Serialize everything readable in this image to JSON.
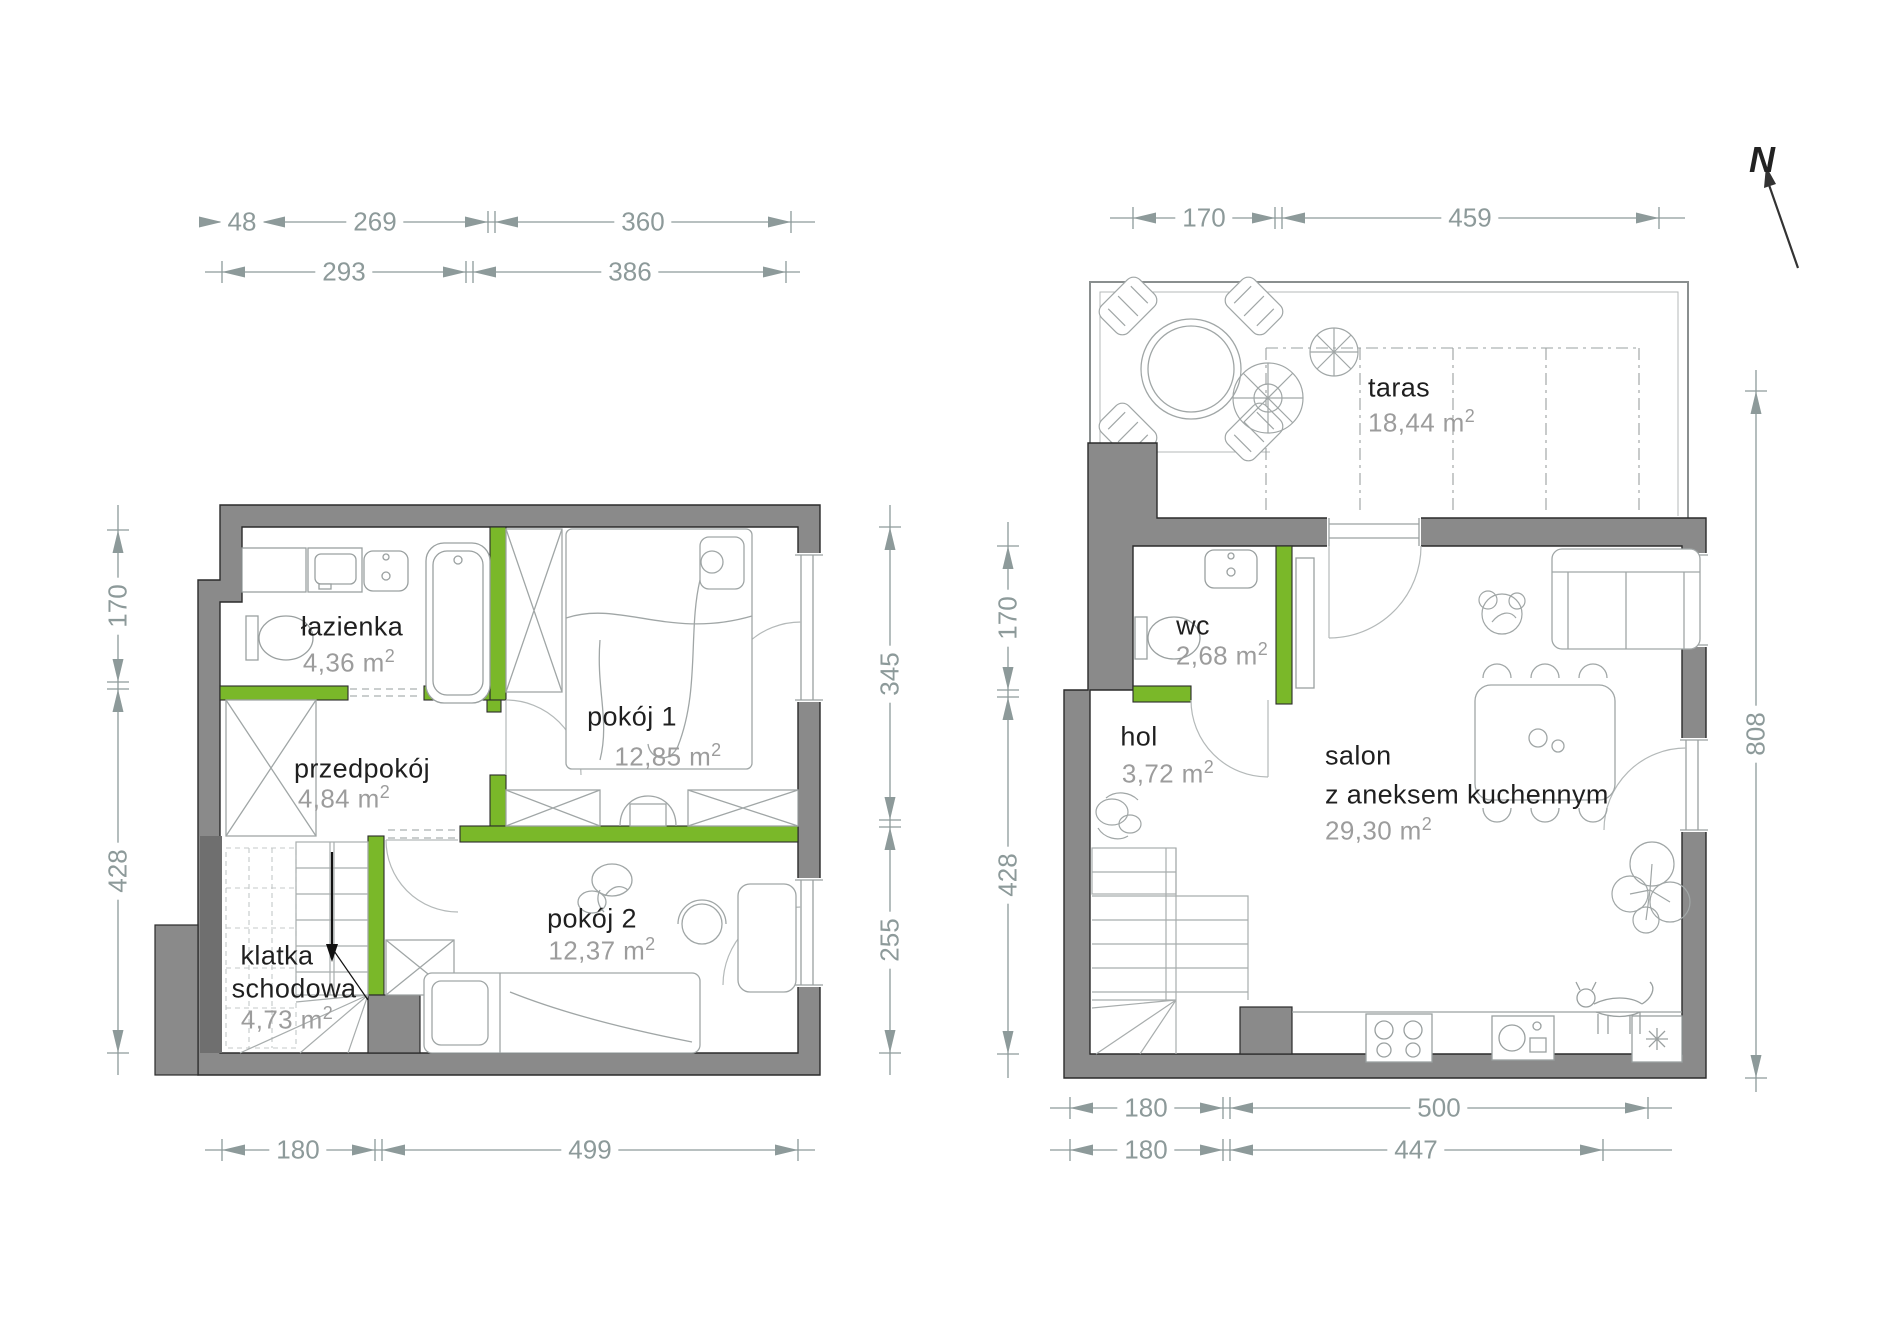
{
  "north": {
    "label": "N"
  },
  "plan_left": {
    "rooms": {
      "lazienka": {
        "name": "łazienka",
        "area": "4,36 m",
        "sup": "2"
      },
      "pokoj1": {
        "name": "pokój 1",
        "area": "12,85 m",
        "sup": "2"
      },
      "przedpokoj": {
        "name": "przedpokój",
        "area": "4,84 m",
        "sup": "2"
      },
      "klatka": {
        "name_line1": "klatka",
        "name_line2": "schodowa",
        "area": "4,73 m",
        "sup": "2"
      },
      "pokoj2": {
        "name": "pokój 2",
        "area": "12,37 m",
        "sup": "2"
      }
    },
    "dims": {
      "top_row1": [
        "48",
        "269",
        "360"
      ],
      "top_row2": [
        "293",
        "386"
      ],
      "left": [
        "170",
        "428"
      ],
      "right": [
        "345",
        "255"
      ],
      "bottom": [
        "180",
        "499"
      ]
    }
  },
  "plan_right": {
    "rooms": {
      "taras": {
        "name": "taras",
        "area": "18,44 m",
        "sup": "2"
      },
      "wc": {
        "name": "wc",
        "area": "2,68 m",
        "sup": "2"
      },
      "hol": {
        "name": "hol",
        "area": "3,72 m",
        "sup": "2"
      },
      "salon": {
        "name_line1": "salon",
        "name_line2": "z aneksem kuchennym",
        "area": "29,30 m",
        "sup": "2"
      }
    },
    "dims": {
      "top": [
        "170",
        "459"
      ],
      "left": [
        "170",
        "428"
      ],
      "right": [
        "808"
      ],
      "bottom_row1": [
        "180",
        "500"
      ],
      "bottom_row2": [
        "180",
        "447"
      ]
    }
  },
  "colors": {
    "wall": "#8a8a8a",
    "accent_green": "#7ab829",
    "dim": "#8d9a9a",
    "room_name": "#1f1f1f",
    "room_area": "#9c9c9c"
  }
}
